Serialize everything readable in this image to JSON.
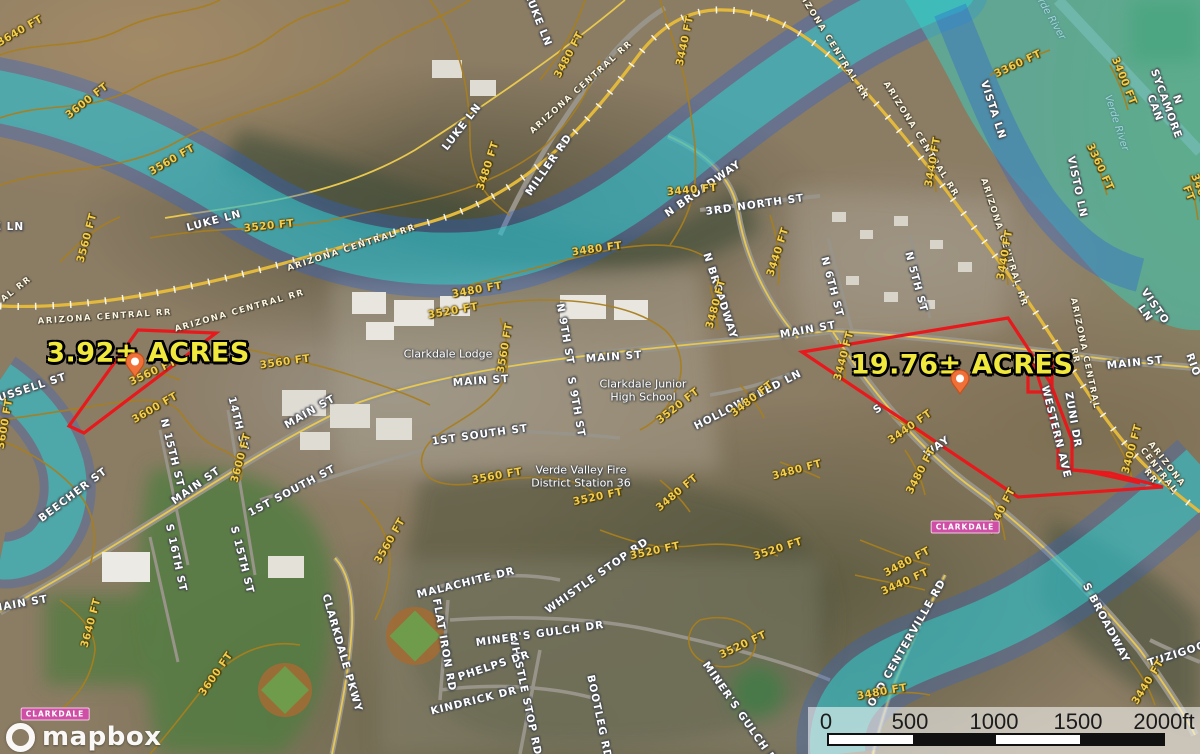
{
  "map": {
    "attribution": {
      "logo_text": "mapbox"
    },
    "scale_bar": {
      "ticks": [
        "0",
        "500",
        "1000",
        "1500",
        "2000ft"
      ]
    },
    "parcels": [
      {
        "label": "3.92± ACRES",
        "label_x": 148,
        "label_y": 353,
        "pin_x": 135,
        "pin_y": 377,
        "outline": [
          [
            138,
            330
          ],
          [
            216,
            333
          ],
          [
            84,
            433
          ],
          [
            69,
            426
          ]
        ]
      },
      {
        "label": "19.76± ACRES",
        "label_x": 962,
        "label_y": 365,
        "pin_x": 960,
        "pin_y": 394,
        "outline": [
          [
            802,
            352
          ],
          [
            1008,
            318
          ],
          [
            1050,
            382
          ],
          [
            1072,
            440
          ],
          [
            1072,
            470
          ],
          [
            1110,
            473
          ],
          [
            1163,
            487
          ],
          [
            1018,
            497
          ]
        ],
        "notch": [
          [
            1028,
            360
          ],
          [
            1052,
            360
          ],
          [
            1052,
            392
          ],
          [
            1028,
            392
          ]
        ],
        "inner_line": [
          [
            1032,
            358
          ],
          [
            1058,
            440
          ],
          [
            1058,
            468
          ],
          [
            1090,
            472
          ],
          [
            1140,
            483
          ]
        ]
      }
    ],
    "place_badges": [
      {
        "text": "CLARKDALE",
        "x": 965,
        "y": 527
      },
      {
        "text": "CLARKDALE",
        "x": 55,
        "y": 714
      }
    ],
    "labels": [
      {
        "text": "LUKE LN",
        "x": 214,
        "y": 221,
        "r": -15,
        "t": "street"
      },
      {
        "text": "LUKE LN",
        "x": 538,
        "y": 20,
        "r": 68,
        "t": "street"
      },
      {
        "text": "LUKE LN",
        "x": 462,
        "y": 127,
        "r": -52,
        "t": "street"
      },
      {
        "text": "MILLER RD",
        "x": 549,
        "y": 165,
        "r": -55,
        "t": "street"
      },
      {
        "text": "N BROADWAY",
        "x": 703,
        "y": 189,
        "r": -35,
        "t": "street"
      },
      {
        "text": "3RD NORTH ST",
        "x": 755,
        "y": 205,
        "r": -8,
        "t": "street"
      },
      {
        "text": "N BROADWAY",
        "x": 720,
        "y": 296,
        "r": 72,
        "t": "street"
      },
      {
        "text": "N 6TH ST",
        "x": 832,
        "y": 287,
        "r": 75,
        "t": "street"
      },
      {
        "text": "N 5TH ST",
        "x": 916,
        "y": 282,
        "r": 75,
        "t": "street"
      },
      {
        "text": "MAIN ST",
        "x": 808,
        "y": 330,
        "r": -10,
        "t": "street"
      },
      {
        "text": "MAIN ST",
        "x": 614,
        "y": 357,
        "r": -4,
        "t": "street"
      },
      {
        "text": "MAIN ST",
        "x": 481,
        "y": 381,
        "r": -4,
        "t": "street"
      },
      {
        "text": "MAIN ST",
        "x": 310,
        "y": 412,
        "r": -30,
        "t": "street"
      },
      {
        "text": "MAIN ST",
        "x": 196,
        "y": 486,
        "r": -35,
        "t": "street"
      },
      {
        "text": "MAIN ST",
        "x": 20,
        "y": 604,
        "r": -10,
        "t": "street"
      },
      {
        "text": "MAIN ST",
        "x": 1135,
        "y": 363,
        "r": -6,
        "t": "street"
      },
      {
        "text": "N 9TH ST",
        "x": 565,
        "y": 334,
        "r": 80,
        "t": "street"
      },
      {
        "text": "S 9TH ST",
        "x": 576,
        "y": 407,
        "r": 80,
        "t": "street"
      },
      {
        "text": "N 15TH ST",
        "x": 172,
        "y": 453,
        "r": 76,
        "t": "street"
      },
      {
        "text": "14TH ST",
        "x": 238,
        "y": 424,
        "r": 76,
        "t": "street"
      },
      {
        "text": "1ST SOUTH ST",
        "x": 480,
        "y": 435,
        "r": -8,
        "t": "street"
      },
      {
        "text": "1ST SOUTH ST",
        "x": 292,
        "y": 491,
        "r": -28,
        "t": "street"
      },
      {
        "text": "BEECHER ST",
        "x": 73,
        "y": 495,
        "r": -37,
        "t": "street"
      },
      {
        "text": "S 16TH ST",
        "x": 176,
        "y": 558,
        "r": 78,
        "t": "street"
      },
      {
        "text": "S 15TH ST",
        "x": 242,
        "y": 560,
        "r": 76,
        "t": "street"
      },
      {
        "text": "RUSSELL ST",
        "x": 28,
        "y": 389,
        "r": -18,
        "t": "street"
      },
      {
        "text": "VISTA LN",
        "x": 993,
        "y": 110,
        "r": 72,
        "t": "street"
      },
      {
        "text": "VISTO LN",
        "x": 1077,
        "y": 187,
        "r": 78,
        "t": "street"
      },
      {
        "text": "VISTO LN",
        "x": 1150,
        "y": 310,
        "r": 55,
        "t": "street"
      },
      {
        "text": "N SYCAMORE CAN",
        "x": 1166,
        "y": 104,
        "r": 70,
        "t": "street"
      },
      {
        "text": "HOLLOW REED LN",
        "x": 748,
        "y": 400,
        "r": -27,
        "t": "street"
      },
      {
        "text": "ZUNI DR",
        "x": 1073,
        "y": 420,
        "r": 80,
        "t": "street"
      },
      {
        "text": "WESTERN AVE",
        "x": 1056,
        "y": 432,
        "r": 76,
        "t": "street"
      },
      {
        "text": "S BROADWAY",
        "x": 1106,
        "y": 623,
        "r": 62,
        "t": "street"
      },
      {
        "text": "TUZIGOOT",
        "x": 1181,
        "y": 653,
        "r": -18,
        "t": "street"
      },
      {
        "text": "OLD CENTERVILLE RD",
        "x": 907,
        "y": 643,
        "r": -60,
        "t": "street"
      },
      {
        "text": "MALACHITE DR",
        "x": 466,
        "y": 583,
        "r": -14,
        "t": "street"
      },
      {
        "text": "WHISTLE STOP RD",
        "x": 597,
        "y": 576,
        "r": -35,
        "t": "street"
      },
      {
        "text": "WHISTLE STOP RD",
        "x": 525,
        "y": 695,
        "r": 78,
        "t": "street"
      },
      {
        "text": "MINER'S GULCH DR",
        "x": 540,
        "y": 634,
        "r": -8,
        "t": "street"
      },
      {
        "text": "MINER'S GULCH DR",
        "x": 742,
        "y": 716,
        "r": 55,
        "t": "street"
      },
      {
        "text": "PHELPS DR",
        "x": 494,
        "y": 666,
        "r": -18,
        "t": "street"
      },
      {
        "text": "KINDRICK DR",
        "x": 474,
        "y": 701,
        "r": -14,
        "t": "street"
      },
      {
        "text": "FLAT IRON RD",
        "x": 444,
        "y": 645,
        "r": 80,
        "t": "street"
      },
      {
        "text": "CLARKDALE PKWY",
        "x": 342,
        "y": 653,
        "r": 74,
        "t": "street"
      },
      {
        "text": "BOOTLEG RD",
        "x": 599,
        "y": 717,
        "r": 78,
        "t": "street"
      },
      {
        "text": "E LN",
        "x": 9,
        "y": 227,
        "r": 0,
        "t": "fragment"
      },
      {
        "text": "S",
        "x": 878,
        "y": 409,
        "r": -35,
        "t": "fragment"
      },
      {
        "text": "WAY",
        "x": 937,
        "y": 447,
        "r": -35,
        "t": "fragment"
      },
      {
        "text": "RIO",
        "x": 1193,
        "y": 365,
        "r": 70,
        "t": "fragment"
      },
      {
        "text": "AL RR",
        "x": 17,
        "y": 290,
        "r": -38,
        "t": "rail"
      },
      {
        "text": "ARIZONA CENTRAL RR",
        "x": 105,
        "y": 318,
        "r": -4,
        "t": "rail"
      },
      {
        "text": "ARIZONA CENTRAL RR",
        "x": 240,
        "y": 312,
        "r": -16,
        "t": "rail"
      },
      {
        "text": "ARIZONA CENTRAL RR",
        "x": 352,
        "y": 249,
        "r": -18,
        "t": "rail"
      },
      {
        "text": "ARIZONA CENTRAL RR",
        "x": 582,
        "y": 88,
        "r": -42,
        "t": "rail"
      },
      {
        "text": "ARIZONA CENTRAL RR",
        "x": 830,
        "y": 43,
        "r": 58,
        "t": "rail"
      },
      {
        "text": "ARIZONA CENTRAL RR",
        "x": 920,
        "y": 140,
        "r": 58,
        "t": "rail"
      },
      {
        "text": "ARIZONA CENTRAL RR",
        "x": 1003,
        "y": 243,
        "r": 72,
        "t": "rail"
      },
      {
        "text": "ARIZONA CENTRAL RR",
        "x": 1079,
        "y": 355,
        "r": 78,
        "t": "rail"
      },
      {
        "text": "ARIZONA CENTRAL RR",
        "x": 1158,
        "y": 471,
        "r": 52,
        "t": "rail"
      },
      {
        "text": "3640 FT",
        "x": 20,
        "y": 31,
        "r": -30,
        "t": "contour"
      },
      {
        "text": "3600 FT",
        "x": 87,
        "y": 101,
        "r": -38,
        "t": "contour"
      },
      {
        "text": "3560 FT",
        "x": 172,
        "y": 160,
        "r": -30,
        "t": "contour"
      },
      {
        "text": "3520 FT",
        "x": 269,
        "y": 226,
        "r": -6,
        "t": "contour"
      },
      {
        "text": "3560 FT",
        "x": 87,
        "y": 238,
        "r": -75,
        "t": "contour"
      },
      {
        "text": "3480 FT",
        "x": 569,
        "y": 55,
        "r": -62,
        "t": "contour"
      },
      {
        "text": "3480 FT",
        "x": 488,
        "y": 166,
        "r": -72,
        "t": "contour"
      },
      {
        "text": "3440 FT",
        "x": 685,
        "y": 41,
        "r": -78,
        "t": "contour"
      },
      {
        "text": "3440 FT",
        "x": 692,
        "y": 190,
        "r": -5,
        "t": "contour"
      },
      {
        "text": "3480 FT",
        "x": 597,
        "y": 249,
        "r": -8,
        "t": "contour"
      },
      {
        "text": "3440 FT",
        "x": 778,
        "y": 252,
        "r": -72,
        "t": "contour"
      },
      {
        "text": "3360 FT",
        "x": 1018,
        "y": 64,
        "r": -25,
        "t": "contour"
      },
      {
        "text": "3400 FT",
        "x": 1124,
        "y": 81,
        "r": 68,
        "t": "contour"
      },
      {
        "text": "3360 FT",
        "x": 1100,
        "y": 167,
        "r": 65,
        "t": "contour"
      },
      {
        "text": "3400 FT",
        "x": 1194,
        "y": 191,
        "r": 68,
        "t": "contour"
      },
      {
        "text": "3440 FT",
        "x": 933,
        "y": 162,
        "r": -80,
        "t": "contour"
      },
      {
        "text": "3440 FT",
        "x": 1005,
        "y": 255,
        "r": -80,
        "t": "contour"
      },
      {
        "text": "3480 FT",
        "x": 477,
        "y": 290,
        "r": -10,
        "t": "contour"
      },
      {
        "text": "3520 FT",
        "x": 453,
        "y": 311,
        "r": -10,
        "t": "contour"
      },
      {
        "text": "3560 FT",
        "x": 505,
        "y": 348,
        "r": -80,
        "t": "contour"
      },
      {
        "text": "3560 FT",
        "x": 285,
        "y": 362,
        "r": -8,
        "t": "contour"
      },
      {
        "text": "3560 FT",
        "x": 153,
        "y": 372,
        "r": -25,
        "t": "contour"
      },
      {
        "text": "3600 FT",
        "x": 155,
        "y": 408,
        "r": -30,
        "t": "contour"
      },
      {
        "text": "3600 FT",
        "x": 241,
        "y": 458,
        "r": -75,
        "t": "contour"
      },
      {
        "text": "3600 FT",
        "x": 5,
        "y": 424,
        "r": -80,
        "t": "contour"
      },
      {
        "text": "3520 FT",
        "x": 678,
        "y": 406,
        "r": -38,
        "t": "contour"
      },
      {
        "text": "3480 FT",
        "x": 752,
        "y": 399,
        "r": -38,
        "t": "contour"
      },
      {
        "text": "3480 FT",
        "x": 716,
        "y": 304,
        "r": -75,
        "t": "contour"
      },
      {
        "text": "3560 FT",
        "x": 497,
        "y": 476,
        "r": -10,
        "t": "contour"
      },
      {
        "text": "3520 FT",
        "x": 598,
        "y": 497,
        "r": -12,
        "t": "contour"
      },
      {
        "text": "3480 FT",
        "x": 677,
        "y": 493,
        "r": -40,
        "t": "contour"
      },
      {
        "text": "3480 FT",
        "x": 797,
        "y": 470,
        "r": -15,
        "t": "contour"
      },
      {
        "text": "3440 FT",
        "x": 844,
        "y": 356,
        "r": -75,
        "t": "contour"
      },
      {
        "text": "3400 FT",
        "x": 1042,
        "y": 360,
        "r": -8,
        "t": "contour"
      },
      {
        "text": "3400 FT",
        "x": 1132,
        "y": 449,
        "r": -75,
        "t": "contour"
      },
      {
        "text": "3440 FT",
        "x": 910,
        "y": 427,
        "r": -35,
        "t": "contour"
      },
      {
        "text": "3480 FT",
        "x": 921,
        "y": 471,
        "r": -62,
        "t": "contour"
      },
      {
        "text": "3440 FT",
        "x": 1001,
        "y": 511,
        "r": -62,
        "t": "contour"
      },
      {
        "text": "3480 FT",
        "x": 907,
        "y": 562,
        "r": -28,
        "t": "contour"
      },
      {
        "text": "3440 FT",
        "x": 905,
        "y": 582,
        "r": -24,
        "t": "contour"
      },
      {
        "text": "3440 FT",
        "x": 1148,
        "y": 682,
        "r": -58,
        "t": "contour"
      },
      {
        "text": "3480 FT",
        "x": 882,
        "y": 692,
        "r": -10,
        "t": "contour"
      },
      {
        "text": "3600 FT",
        "x": 216,
        "y": 674,
        "r": -55,
        "t": "contour"
      },
      {
        "text": "3640 FT",
        "x": 91,
        "y": 623,
        "r": -75,
        "t": "contour"
      },
      {
        "text": "3560 FT",
        "x": 390,
        "y": 541,
        "r": -60,
        "t": "contour"
      },
      {
        "text": "3520 FT",
        "x": 655,
        "y": 551,
        "r": -12,
        "t": "contour"
      },
      {
        "text": "3520 FT",
        "x": 743,
        "y": 645,
        "r": -25,
        "t": "contour"
      },
      {
        "text": "3520 FT",
        "x": 778,
        "y": 549,
        "r": -18,
        "t": "contour"
      },
      {
        "text": "Clarkdale Lodge",
        "x": 448,
        "y": 355,
        "r": 0,
        "t": "poi"
      },
      {
        "text": "Clarkdale Junior\nHigh School",
        "x": 643,
        "y": 391,
        "r": 0,
        "t": "poi"
      },
      {
        "text": "Verde Valley Fire\nDistrict Station 36",
        "x": 581,
        "y": 477,
        "r": 0,
        "t": "poi"
      },
      {
        "text": "Verde River",
        "x": 1048,
        "y": 14,
        "r": 60,
        "t": "water"
      },
      {
        "text": "Verde River",
        "x": 1116,
        "y": 123,
        "r": 72,
        "t": "water"
      }
    ],
    "colors": {
      "parcel_outline": "#e8191c",
      "acres_text": "#f0e83c",
      "flood_teal": "#2fd9c9",
      "flood_blue": "#2a62d8",
      "contour_line": "#a87f1f",
      "contour_text": "#f2cd4e",
      "railroad": "#e2b93c",
      "badge_pink": "#cf4fa6",
      "pin_orange": "#f07038"
    }
  }
}
